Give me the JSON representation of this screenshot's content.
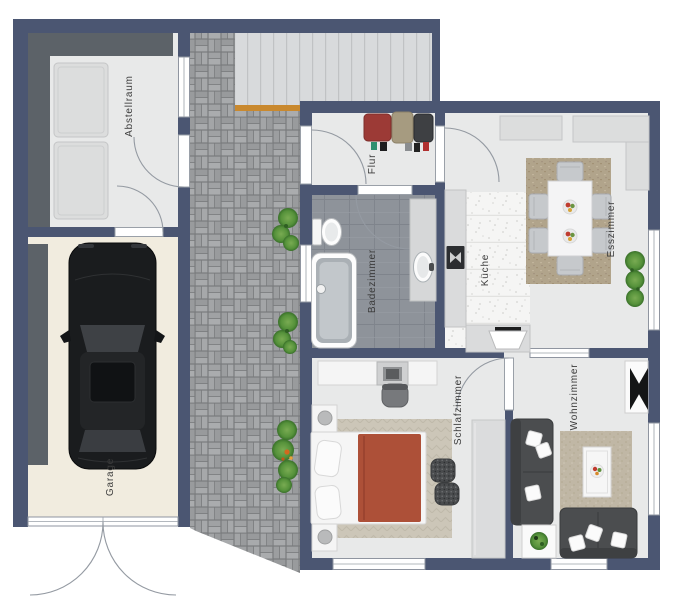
{
  "rooms": {
    "abstellraum": {
      "label": "Abstellraum"
    },
    "garage": {
      "label": "Garage"
    },
    "flur": {
      "label": "Flur"
    },
    "badezimmer": {
      "label": "Badezimmer"
    },
    "kueche": {
      "label": "Küche"
    },
    "esszimmer": {
      "label": "Esszimmer"
    },
    "schlafzimmer": {
      "label": "Schlafzimmer"
    },
    "wohnzimmer": {
      "label": "Wohnzimmer"
    }
  },
  "colors": {
    "wall": "#4b5672",
    "shelf": "#5c6268",
    "floor": "#e8e9e9",
    "garage-floor": "#f1ecdf",
    "bath-tile": "#8e939a",
    "kitchen-floor": "#f5f5f4",
    "deck": "#d8dadc",
    "step": "#c9892f",
    "dining-rug": "#b1a48b",
    "living-rug": "#c0b7a5",
    "bed-rug": "#ccc6b8",
    "blanket": "#ad5038",
    "sofa": "#4b4d4f",
    "plant": "#4e8a33",
    "car": "#1a1c1e"
  }
}
